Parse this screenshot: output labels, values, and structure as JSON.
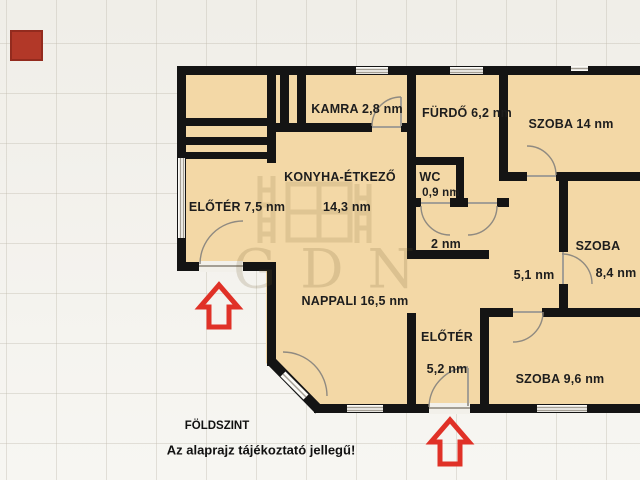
{
  "watermark": {
    "text": "GDN"
  },
  "labels": {
    "kamra": "KAMRA 2,8 nm",
    "furdo": "FÜRDŐ 6,2 nm",
    "szoba14": "SZOBA 14 nm",
    "konyha": "KONYHA-ÉTKEZŐ",
    "konyha_area": "14,3 nm",
    "wc": "WC",
    "wc_area": "0,9 nm",
    "hall2": "2 nm",
    "eloter75": "ELŐTÉR 7,5 nm",
    "hall51": "5,1 nm",
    "szoba84_name": "SZOBA",
    "szoba84_area": "8,4 nm",
    "nappali": "NAPPALI 16,5 nm",
    "eloter52_name": "ELŐTÉR",
    "eloter52_area": "5,2 nm",
    "szoba96": "SZOBA 9,6 nm"
  },
  "footer": {
    "level": "FÖLDSZINT",
    "note": "Az alaprajz tájékoztató jellegű!"
  },
  "colors": {
    "floor": "#f3d8a6",
    "wall": "#141414",
    "arrow": "#e03127",
    "logo_square": "#b23828"
  }
}
